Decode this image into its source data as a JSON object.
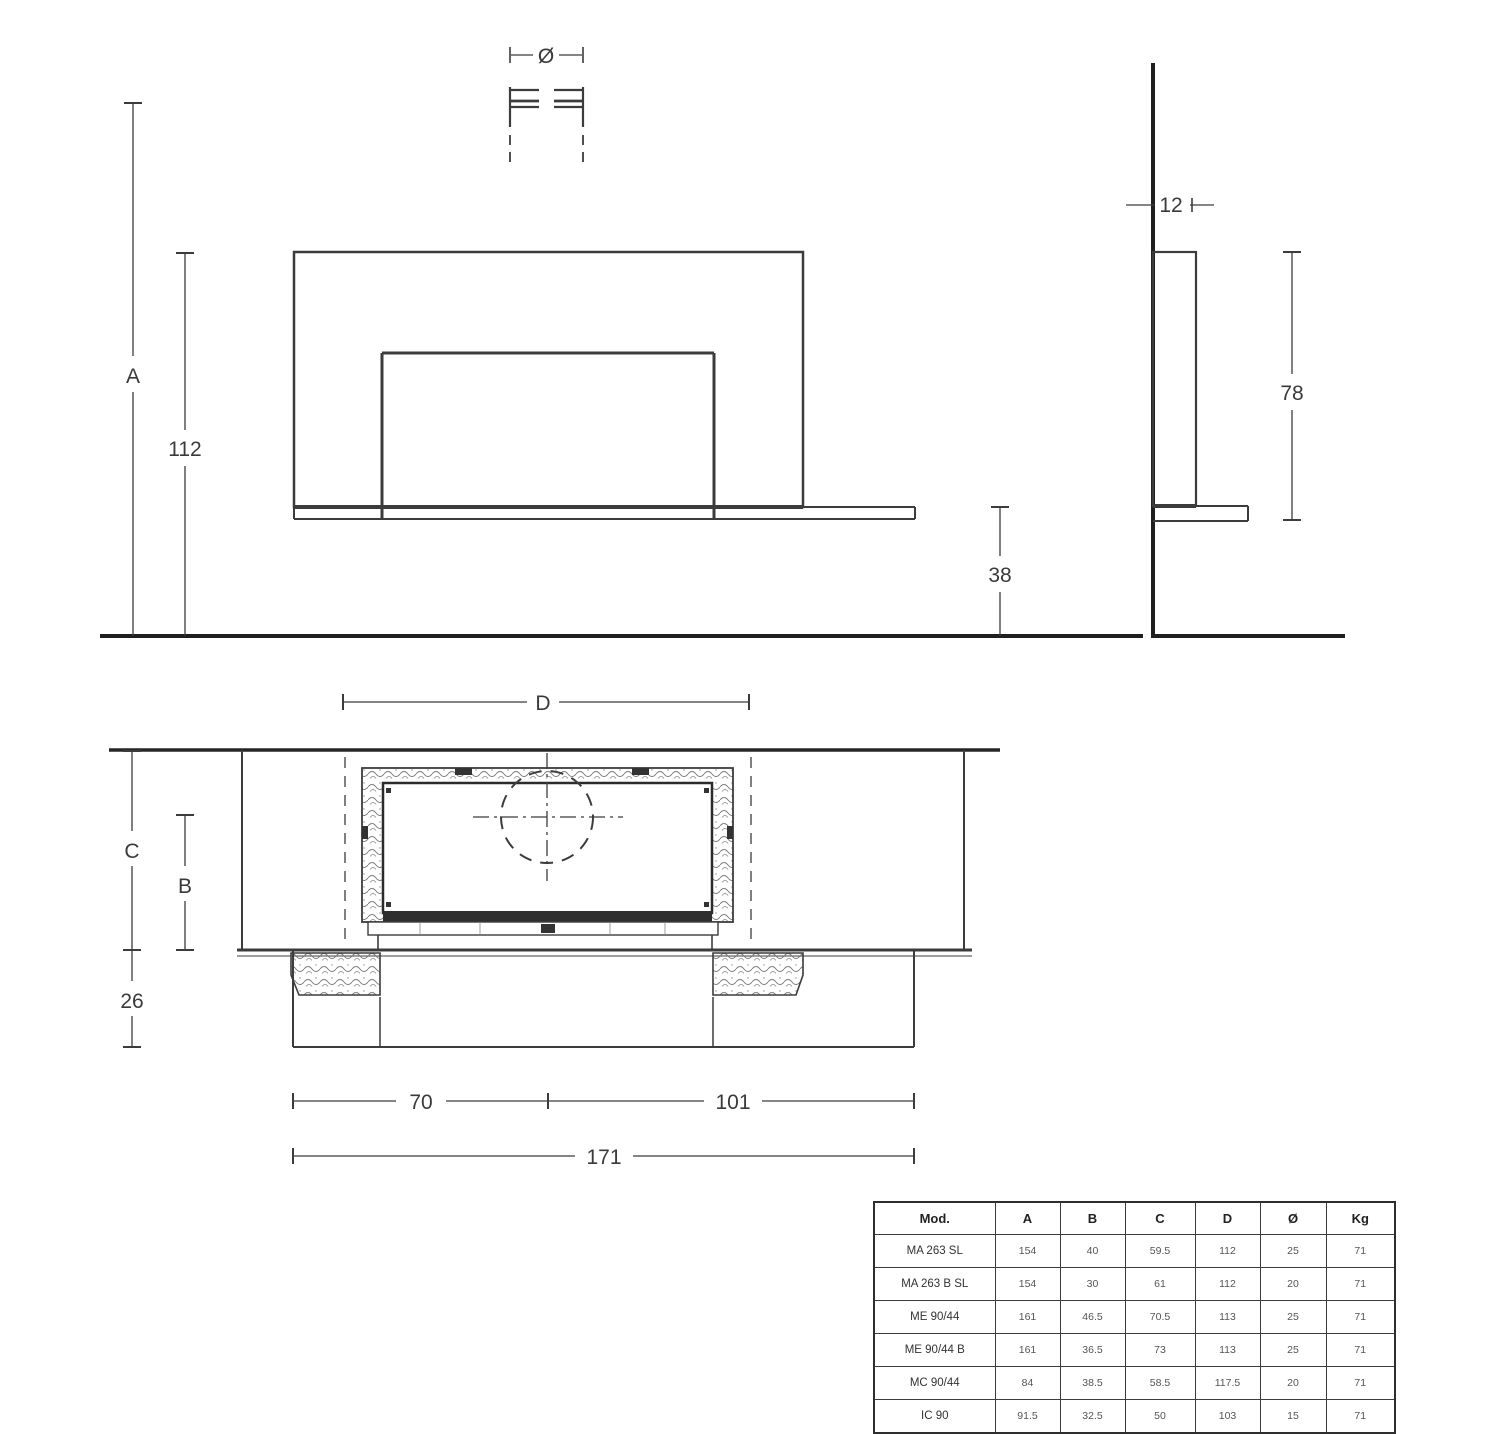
{
  "page": {
    "background": "#ffffff",
    "line_color": "#3c3c3c",
    "bold_line_color": "#1f1f1f"
  },
  "front_view": {
    "flue_diameter_label": "Ø",
    "dim_overall_height": "A",
    "dim_body_height": "112",
    "dim_bench_height": "38"
  },
  "side_view": {
    "dim_top_depth": "12",
    "dim_body_height": "78"
  },
  "plan_view": {
    "dim_firebox_width": "D",
    "dim_total_depth": "C",
    "dim_firebox_depth": "B",
    "dim_base_depth": "26",
    "dim_base_left": "70",
    "dim_base_right": "101",
    "dim_base_total": "171"
  },
  "spec_table": {
    "headers": [
      "Mod.",
      "A",
      "B",
      "C",
      "D",
      "Ø",
      "Kg"
    ],
    "rows": [
      {
        "model": "MA 263 SL",
        "values": [
          "154",
          "40",
          "59.5",
          "112",
          "25",
          "71"
        ]
      },
      {
        "model": "MA 263 B SL",
        "values": [
          "154",
          "30",
          "61",
          "112",
          "20",
          "71"
        ]
      },
      {
        "model": "ME 90/44",
        "values": [
          "161",
          "46.5",
          "70.5",
          "113",
          "25",
          "71"
        ]
      },
      {
        "model": "ME 90/44 B",
        "values": [
          "161",
          "36.5",
          "73",
          "113",
          "25",
          "71"
        ]
      },
      {
        "model": "MC 90/44",
        "values": [
          "84",
          "38.5",
          "58.5",
          "117.5",
          "20",
          "71"
        ]
      },
      {
        "model": "IC 90",
        "values": [
          "91.5",
          "32.5",
          "50",
          "103",
          "15",
          "71"
        ]
      }
    ]
  }
}
